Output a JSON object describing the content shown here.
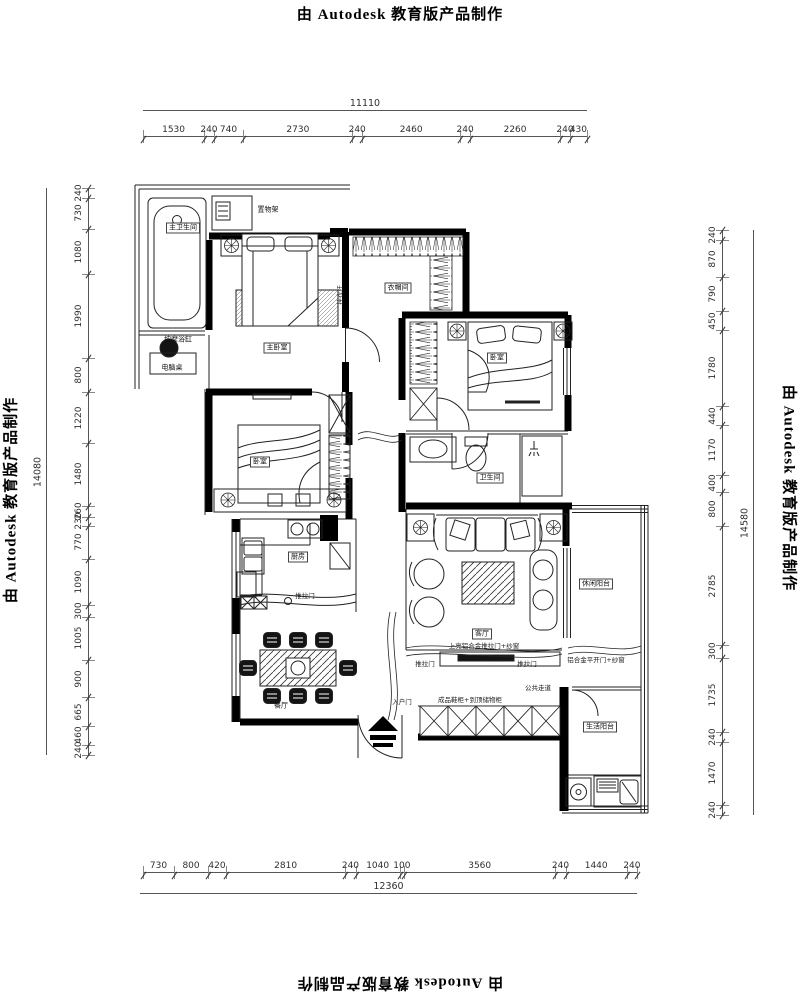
{
  "stamp": {
    "text": "由 Autodesk 教育版产品制作"
  },
  "dims": {
    "top": {
      "total": "11110",
      "segments": [
        1530,
        240,
        740,
        2730,
        240,
        2460,
        240,
        2260,
        240,
        430
      ]
    },
    "bottom": {
      "total": "12360",
      "segments": [
        730,
        800,
        420,
        2810,
        240,
        1040,
        100,
        3560,
        240,
        1440,
        240
      ]
    },
    "left": {
      "total": "14080",
      "segments": [
        240,
        730,
        1080,
        1990,
        800,
        1220,
        1480,
        260,
        230,
        770,
        1090,
        300,
        1005,
        900,
        665,
        460,
        240
      ]
    },
    "right": {
      "total": "14580",
      "segments": [
        240,
        870,
        790,
        450,
        1780,
        440,
        1170,
        400,
        800,
        2785,
        300,
        1735,
        240,
        1470,
        240
      ]
    }
  },
  "rooms": {
    "master_bath": "主卫生间",
    "vanity": "置物架",
    "tub": "按摩浴缸",
    "master_bedroom": "主卧室",
    "desk": "电脑桌",
    "cloakroom": "衣帽间",
    "bedroom2": "卧室",
    "bedroom3": "卧室",
    "bathroom": "卫生间",
    "living": "客厅",
    "kitchen": "厨房",
    "dining": "餐厅",
    "balcony_leisure": "休闲阳台",
    "balcony_service": "生活阳台"
  },
  "annotations": {
    "hanger_rod": "挂衣杆",
    "sliding_door_1": "推拉门",
    "sliding_door_2": "推拉门",
    "sliding_door_3": "推拉门",
    "top_slide": "上亮铝合金推拉门+纱窗",
    "swing_door": "铝合金平开门+纱窗",
    "shoe_cabinet": "成品鞋柜+到顶储物柜",
    "corridor": "公共走道",
    "entry_door": "入户门"
  }
}
